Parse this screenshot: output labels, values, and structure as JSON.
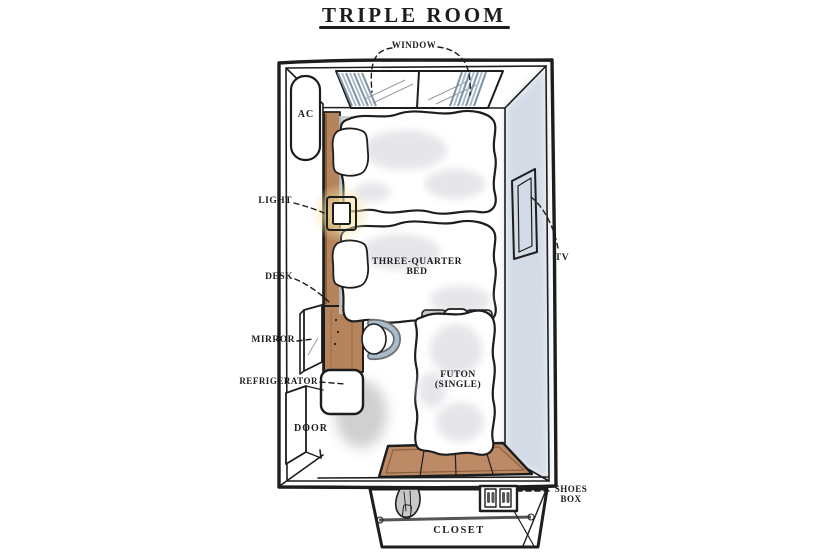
{
  "title": "TRIPLE ROOM",
  "labels": {
    "window": "WINDOW",
    "ac": "AC",
    "light": "LIGHT",
    "desk": "DESK",
    "mirror": "MIRROR",
    "refrigerator": "REFRIGERATOR",
    "door": "DOOR",
    "three_quarter_bed_line1": "THREE-QUARTER",
    "three_quarter_bed_line2": "BED",
    "futon_line1": "FUTON",
    "futon_line2": "(SINGLE)",
    "tv": "TV",
    "shoes_box_line1": "SHOES",
    "shoes_box_line2": "BOX",
    "closet": "CLOSET"
  },
  "colors": {
    "ink": "#1d1d1d",
    "wood": "#b5835c",
    "wood_dark": "#8a5f3c",
    "mat_wood": "#bc8b66",
    "wall_shade": "#c9d3e0",
    "curtain": "#a8bccb",
    "curtain_dark": "#7f93a6",
    "glow": "#f4e2a0",
    "shadow_gray": "#c8c8c8",
    "bed_shade": "#e6e6ea",
    "tv_dark": "#565b62",
    "tv_mid": "#8e9399"
  }
}
